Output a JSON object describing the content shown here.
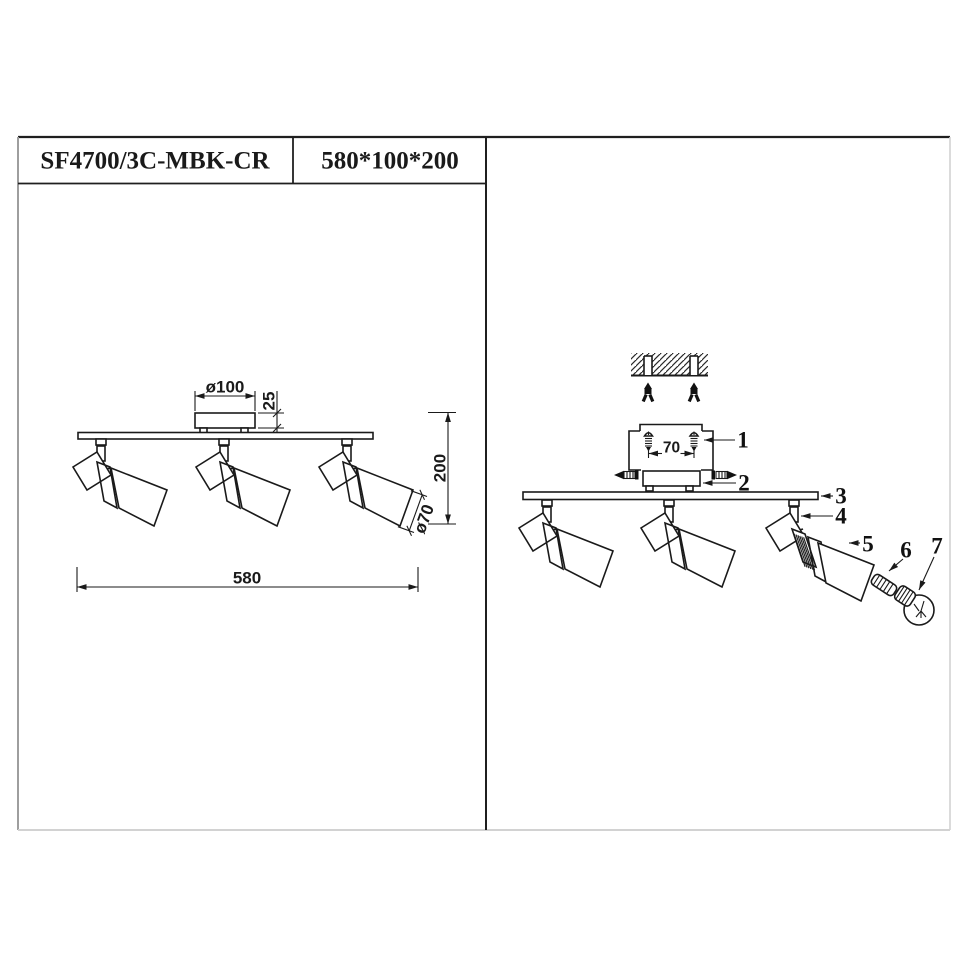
{
  "title_block": {
    "model": "SF4700/3C-MBK-CR",
    "overall_size": "580*100*200"
  },
  "front_view": {
    "dims": {
      "canopy_diameter": "ø100",
      "canopy_height": "25",
      "overall_height": "200",
      "shade_diameter": "ø70",
      "overall_width": "580"
    }
  },
  "install_view": {
    "screw_spacing": "70",
    "part_numbers": [
      "1",
      "2",
      "3",
      "4",
      "5",
      "6",
      "7"
    ]
  },
  "colors": {
    "ink": "#1a1a1a",
    "band_dark": "#2e2e2e",
    "band_light": "#e9e9e9",
    "frame_gray": "#9e9e9e",
    "frame_light": "#d2d2d2"
  }
}
